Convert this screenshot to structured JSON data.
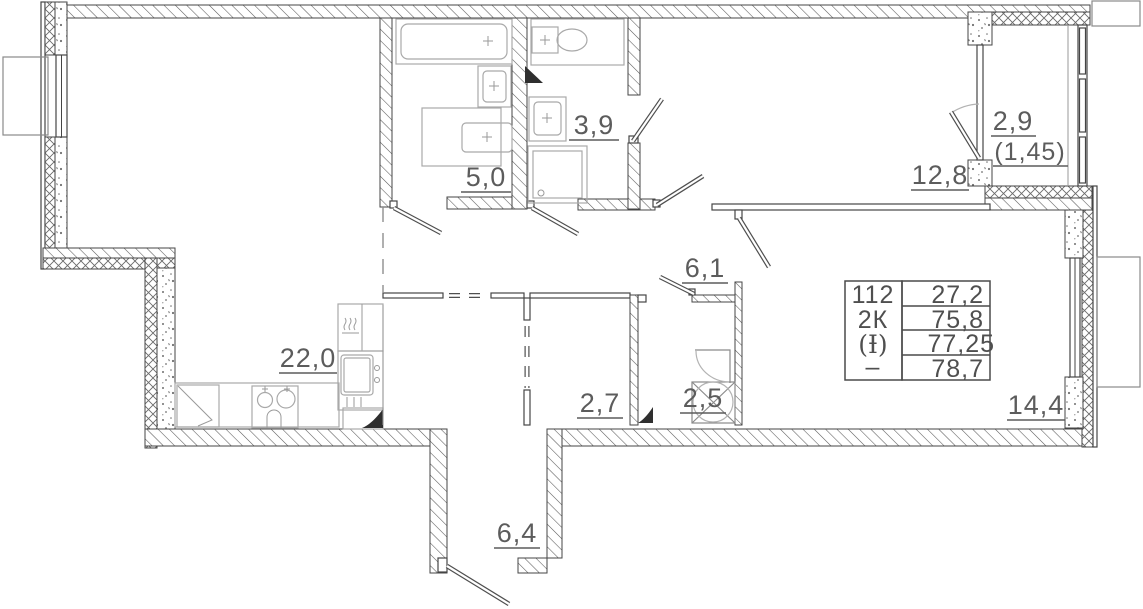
{
  "rooms": {
    "bathroom": "5,0",
    "toilet_top": "3,9",
    "balcony": "2,9",
    "balcony_reduced": "(1,45)",
    "bedroom_top_right": "12,8",
    "hallway": "6,1",
    "living_kitchen": "22,0",
    "wardrobe": "2,7",
    "toilet_bottom": "2,5",
    "bedroom_right": "14,4",
    "entry_hall": "6,4"
  },
  "stamp": {
    "rows": [
      {
        "label": "112",
        "value": "27,2"
      },
      {
        "label": "2К",
        "value": "75,8"
      },
      {
        "label": "(Ɨ)",
        "value": "77,25"
      },
      {
        "label": "–",
        "value": "78,7"
      }
    ]
  },
  "colors": {
    "line": "#454545",
    "fixture": "#a9a9a9",
    "text": "#5c5c5c"
  }
}
